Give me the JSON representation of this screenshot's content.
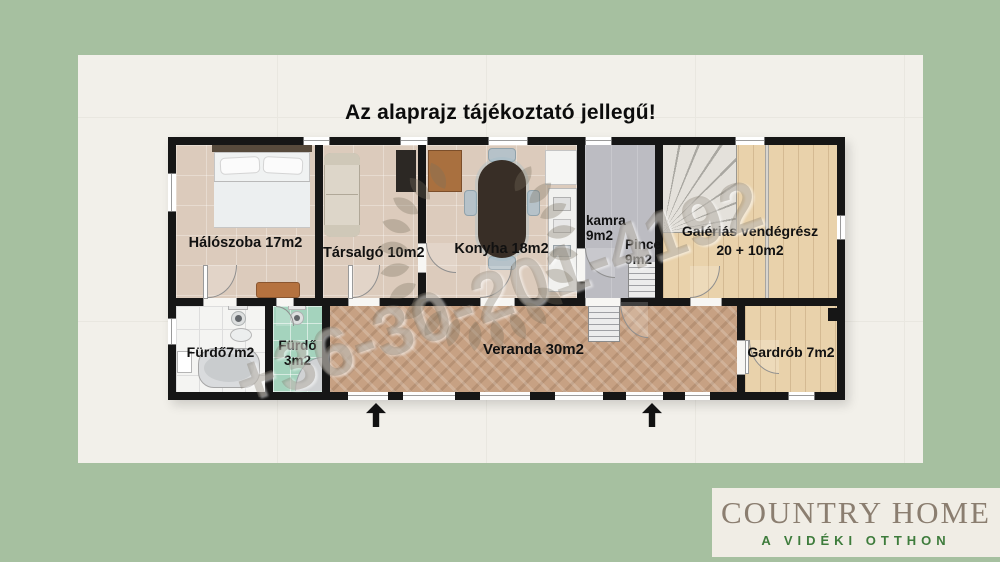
{
  "title": "Az alaprajz tájékoztató jellegű!",
  "watermark": {
    "phone": "+36-30-201-4192"
  },
  "rooms": {
    "haloszoba": {
      "label": "Hálószoba 17m2"
    },
    "tarsalgo": {
      "label": "Társalgó 10m2"
    },
    "konyha": {
      "label": "Konyha 18m2"
    },
    "kamra": {
      "name": "kamra",
      "area": "9m2"
    },
    "pince": {
      "name": "Pince",
      "area": "9m2"
    },
    "galerias": {
      "name": "Galériás vendégrész",
      "area": "20 + 10m2"
    },
    "furdo_nagy": {
      "label": "Fürdő7m2"
    },
    "furdo_kis": {
      "name": "Fürdő",
      "area": "3m2"
    },
    "veranda": {
      "label": "Veranda 30m2"
    },
    "gardrob": {
      "label": "Gardrób 7m2"
    }
  },
  "logo": {
    "brand": "COUNTRY HOME",
    "tagline": "A VIDÉKI OTTHON"
  },
  "colors": {
    "background_green": "#a6c0a0",
    "canvas": "#f2f0ea",
    "wall": "#161616",
    "wood_floor": "#e9d2ab",
    "veranda_floor": "#c7a183",
    "bath_green": "#a4d3bd",
    "logo_green": "#3e7c3c",
    "logo_brand_gray": "#8b7e70"
  }
}
